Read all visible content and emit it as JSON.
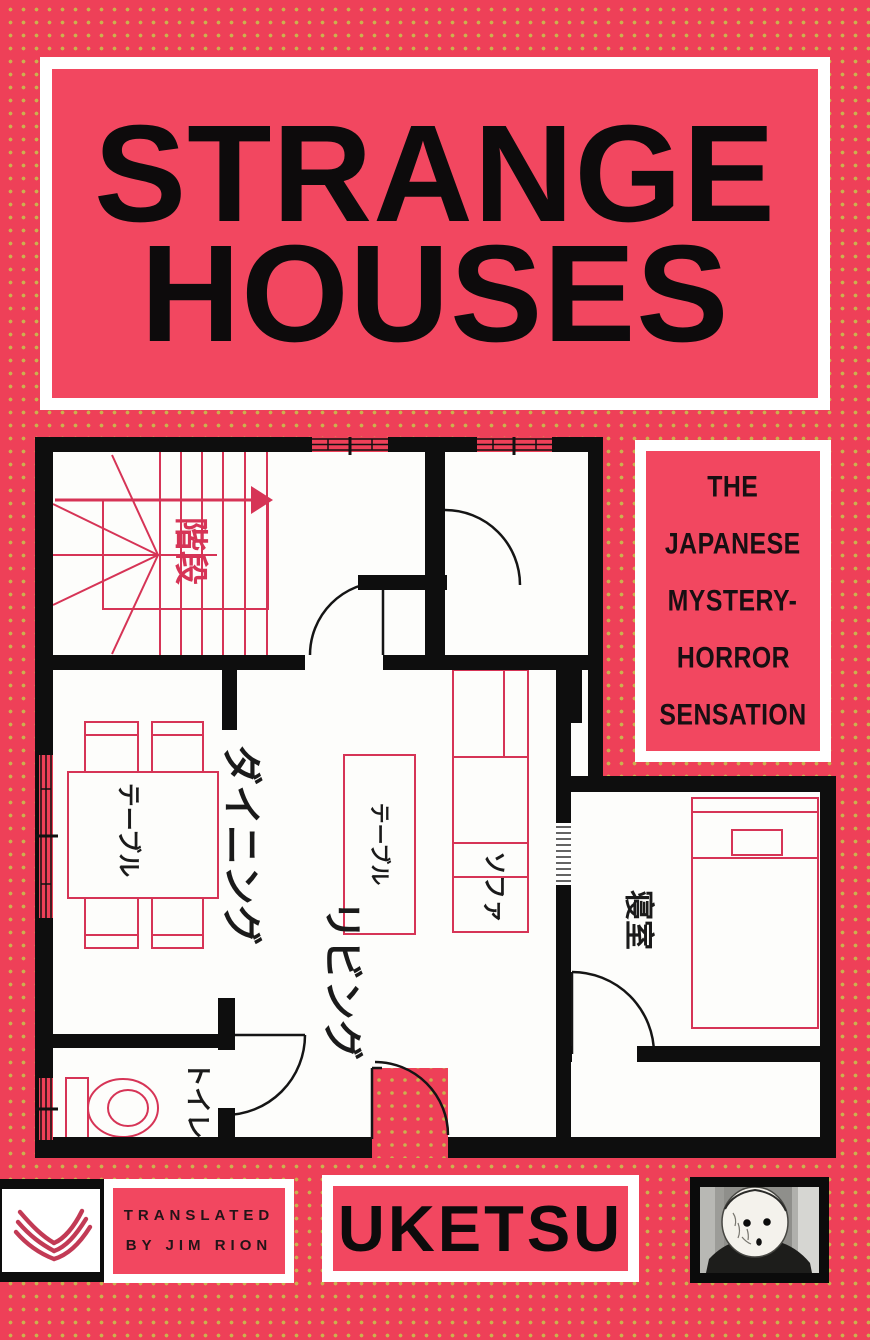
{
  "book_cover": {
    "title": {
      "line1": "STRANGE",
      "line2": "HOUSES"
    },
    "tagline": [
      "THE",
      "JAPANESE",
      "MYSTERY-",
      "HORROR",
      "SENSATION"
    ],
    "translator": {
      "line1": "TRANSLATED",
      "line2": "BY JIM RION"
    },
    "author": "UKETSU",
    "icons": {
      "publisher_logo": "harpervia-chevron-mark",
      "author_photo": "masked-figure-photo"
    },
    "colors": {
      "background_pink": "#ee4058",
      "panel_pink": "#f24760",
      "dot_yellow": "#cab14e",
      "ink_black": "#0d0b0c",
      "plan_line_pink": "#d63456",
      "logo_red": "#c23a55",
      "white": "#ffffff"
    }
  },
  "floor_plan": {
    "room_labels": {
      "stairs": "階段",
      "dining": "ダイニング",
      "living": "リビング",
      "toilet": "トイレ",
      "bedroom": "寝室"
    },
    "furniture_labels": {
      "dining_table": "テーブル",
      "living_table": "テーブル",
      "sofa": "ソファ"
    }
  }
}
